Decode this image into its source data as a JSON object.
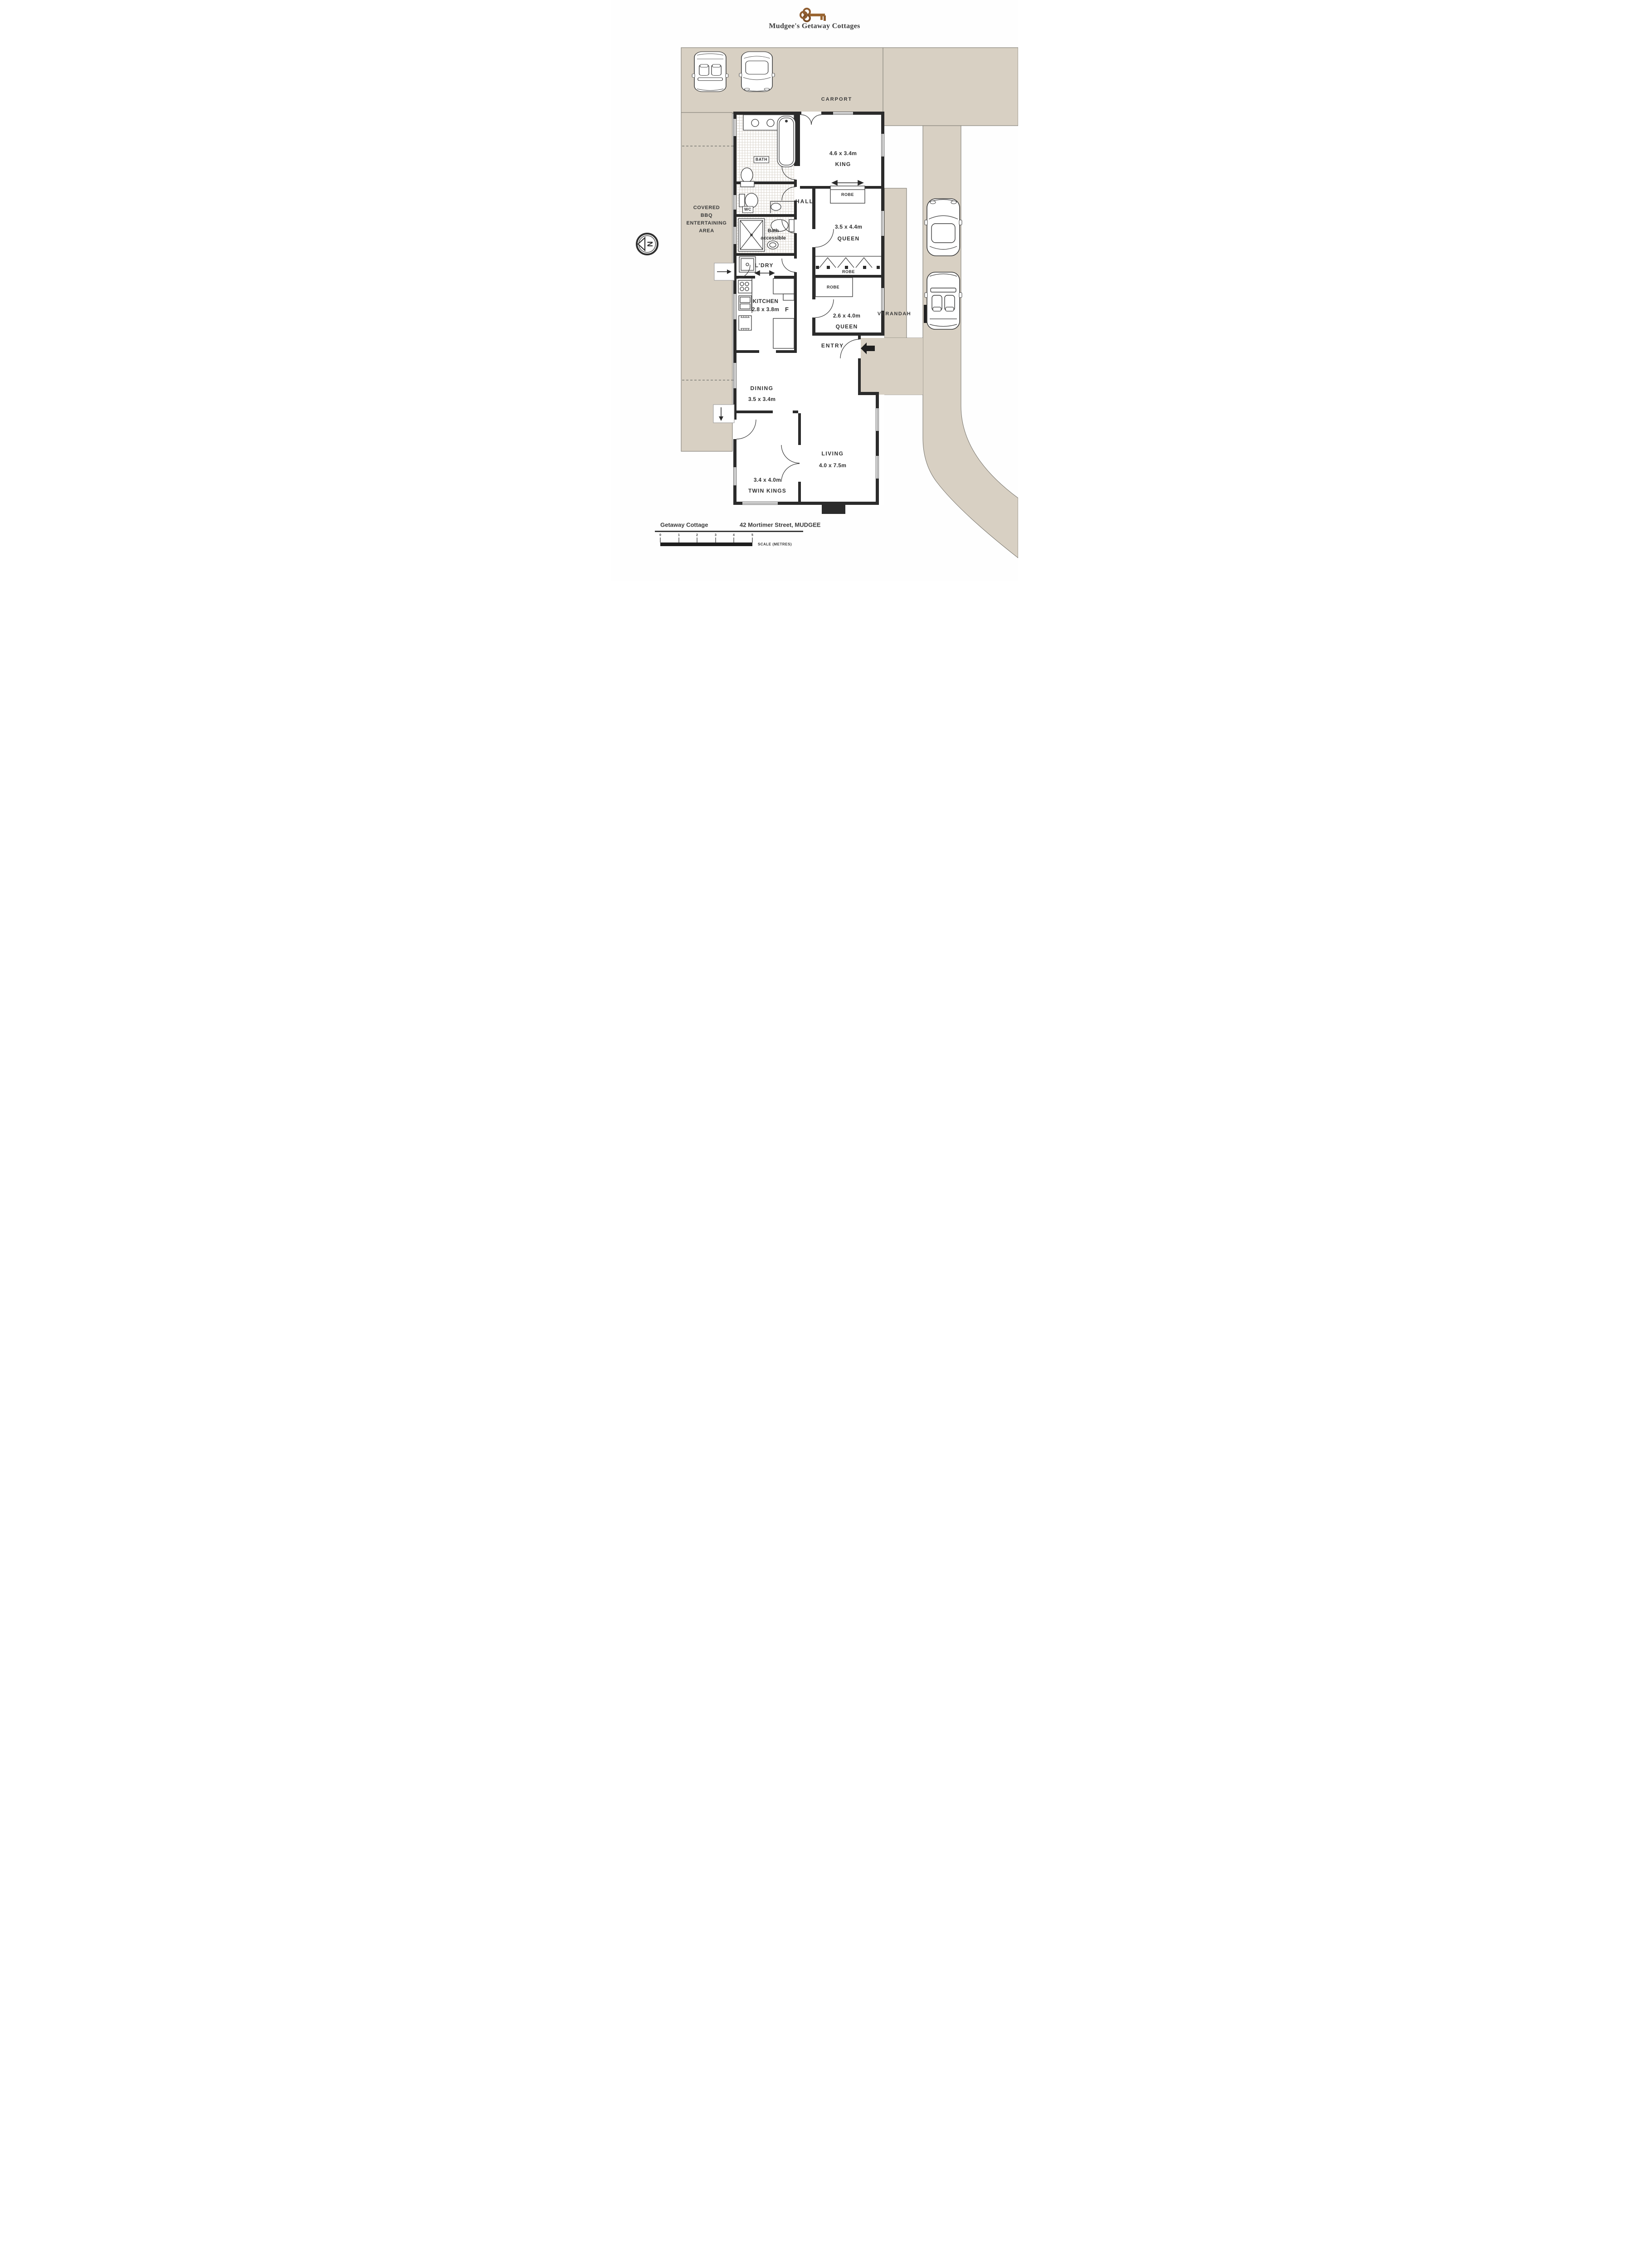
{
  "title": "Mudgee's Getaway Cottages",
  "colors": {
    "site_beige": "#d8d0c3",
    "wall": "#2b2b2b",
    "key_bronze": "#8f5d30"
  },
  "carport": {
    "label": "CARPORT"
  },
  "bbq": {
    "lines": [
      "COVERED",
      "BBQ",
      "ENTERTAINING",
      "AREA"
    ]
  },
  "compass": {
    "letter": "N"
  },
  "rooms": {
    "king": {
      "dim": "4.6 x 3.4m",
      "name": "KING"
    },
    "queen1": {
      "dim": "3.5 x 4.4m",
      "name": "QUEEN"
    },
    "queen2": {
      "dim": "2.6 x 4.0m",
      "name": "QUEEN"
    },
    "twin": {
      "dim": "3.4 x 4.0m",
      "name": "TWIN KINGS"
    },
    "living": {
      "name": "LIVING",
      "dim": "4.0 x 7.5m"
    },
    "dining": {
      "name": "DINING",
      "dim": "3.5 x 3.4m"
    },
    "kitchen": {
      "name": "KITCHEN",
      "dim": "2.8 x 3.8m"
    },
    "ldry": "L'DRY",
    "hall": "HALL",
    "bath": "BATH",
    "wc": "WC",
    "bath_acc": {
      "l1": "Bath",
      "l2": "accessible"
    },
    "fridge": "F",
    "entry": "ENTRY",
    "verandah": "VERANDAH",
    "robe_king": "ROBE",
    "robe_q1": "ROBE",
    "robe_q2": "ROBE"
  },
  "footer": {
    "property": "Getaway Cottage",
    "address": "42 Mortimer Street, MUDGEE",
    "scale_label": "SCALE (METRES)",
    "ticks": [
      "0",
      "1",
      "2",
      "3",
      "4",
      "5"
    ]
  }
}
